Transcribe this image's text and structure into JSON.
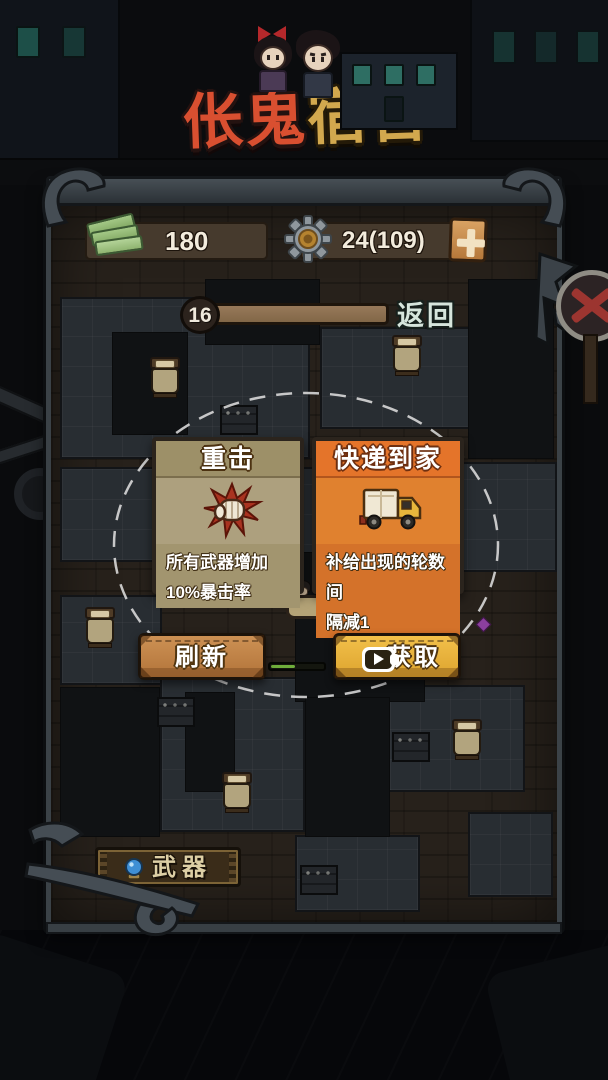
{
  "game": {
    "title_red": "伥鬼",
    "title_gold": "宿舍"
  },
  "hud": {
    "money": "180",
    "gear_count": "24(109)",
    "wave": "16",
    "back": "返回"
  },
  "upgrade_cards": [
    {
      "title": "重击",
      "desc_line1": "所有武器增加",
      "desc_line2": "10%暴击率",
      "icon": "fist-impact"
    },
    {
      "title": "快递到家",
      "desc_line1": "补给出现的轮数间",
      "desc_line2": "隔减1",
      "icon": "delivery-truck"
    }
  ],
  "actions": {
    "refresh": "刷新",
    "claim": "获取"
  },
  "footer": {
    "weapons": "武器"
  },
  "colors": {
    "card_tan": "#ada07e",
    "card_orange": "#e0812f",
    "button_gold": "#edb83d",
    "button_copper": "#c3824a",
    "progress_green": "#6fad3b",
    "title_red": "#d94f30",
    "title_gold": "#d2a84e",
    "panel_frame": "#3b4247"
  }
}
